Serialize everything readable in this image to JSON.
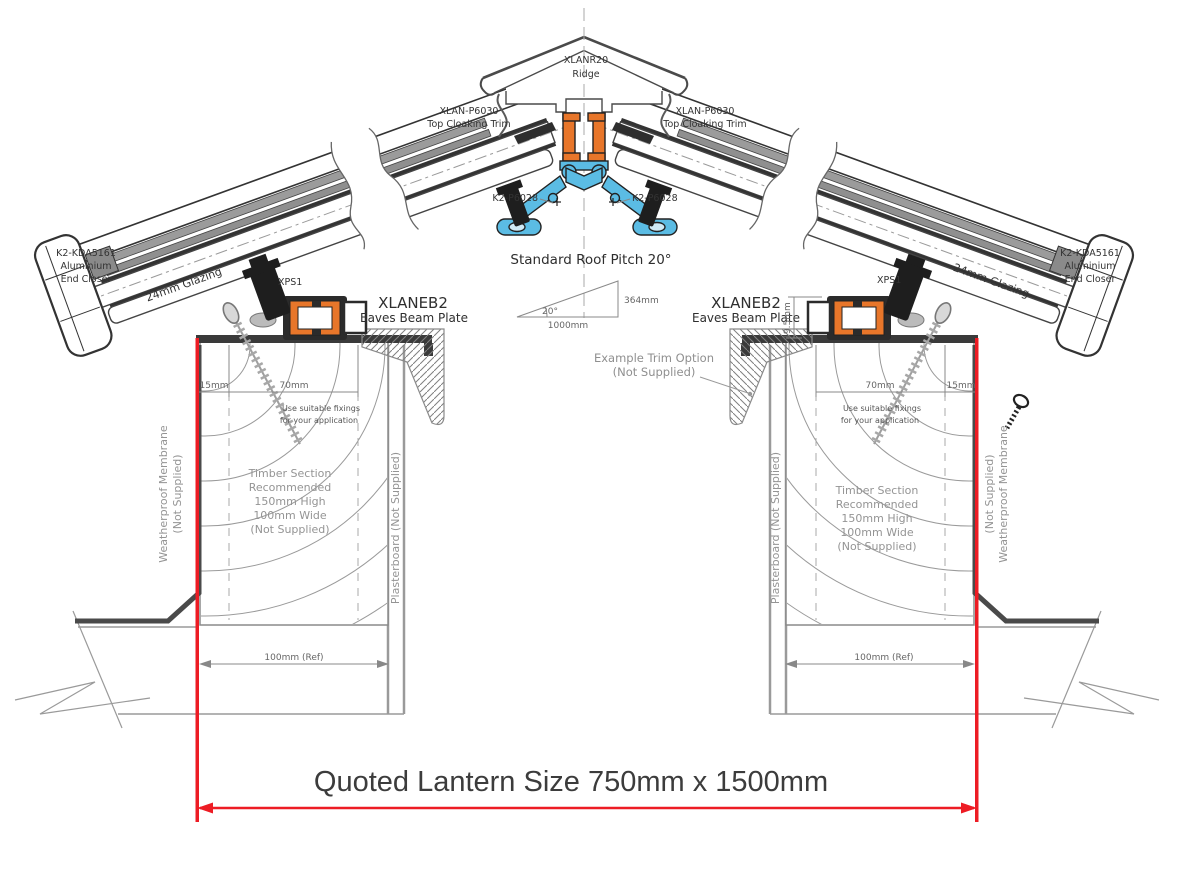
{
  "drawing": {
    "type": "roof-lantern-cross-section",
    "colors": {
      "accent_orange": "#E8762A",
      "accent_blue": "#5BBCE4",
      "highlight_red": "#ED1C24",
      "line_dark": "#333333",
      "annotation_gray": "#8F8F8F"
    },
    "parts": {
      "ridge_code": "XLANR20",
      "ridge_name": "Ridge",
      "cloaking_code": "XLAN-P6030",
      "cloaking_name": "Top Cloaking Trim",
      "plate_code": "K2-P6028",
      "end_closer_code": "K2-KDA5161",
      "end_closer_l2": "Aluminium",
      "end_closer_l3": "End Closer",
      "glazing": "24mm Glazing",
      "xps": "XPS1",
      "eaves_code": "XLANEB2",
      "eaves_name": "Eaves Beam Plate"
    },
    "notes": {
      "pitch": "Standard Roof Pitch 20°",
      "fixings_l1": "Use suitable fixings",
      "fixings_l2": "for your application",
      "timber_l1": "Timber Section",
      "timber_l2": "Recommended",
      "timber_l3": "150mm High",
      "timber_l4": "100mm Wide",
      "timber_l5": "(Not Supplied)",
      "membrane_l1": "Weatherproof Membrane",
      "membrane_l2": "(Not Supplied)",
      "plasterboard": "Plasterboard (Not Supplied)",
      "trim_l1": "Example  Trim Option",
      "trim_l2": "(Not Supplied)"
    },
    "dims": {
      "angle": "20°",
      "run": "1000mm",
      "rise": "364mm",
      "d15": "15mm",
      "d70": "70mm",
      "d195": "19.5mm",
      "d100": "100mm (Ref)"
    },
    "quote": {
      "text": "Quoted Lantern Size 750mm x 1500mm"
    }
  }
}
